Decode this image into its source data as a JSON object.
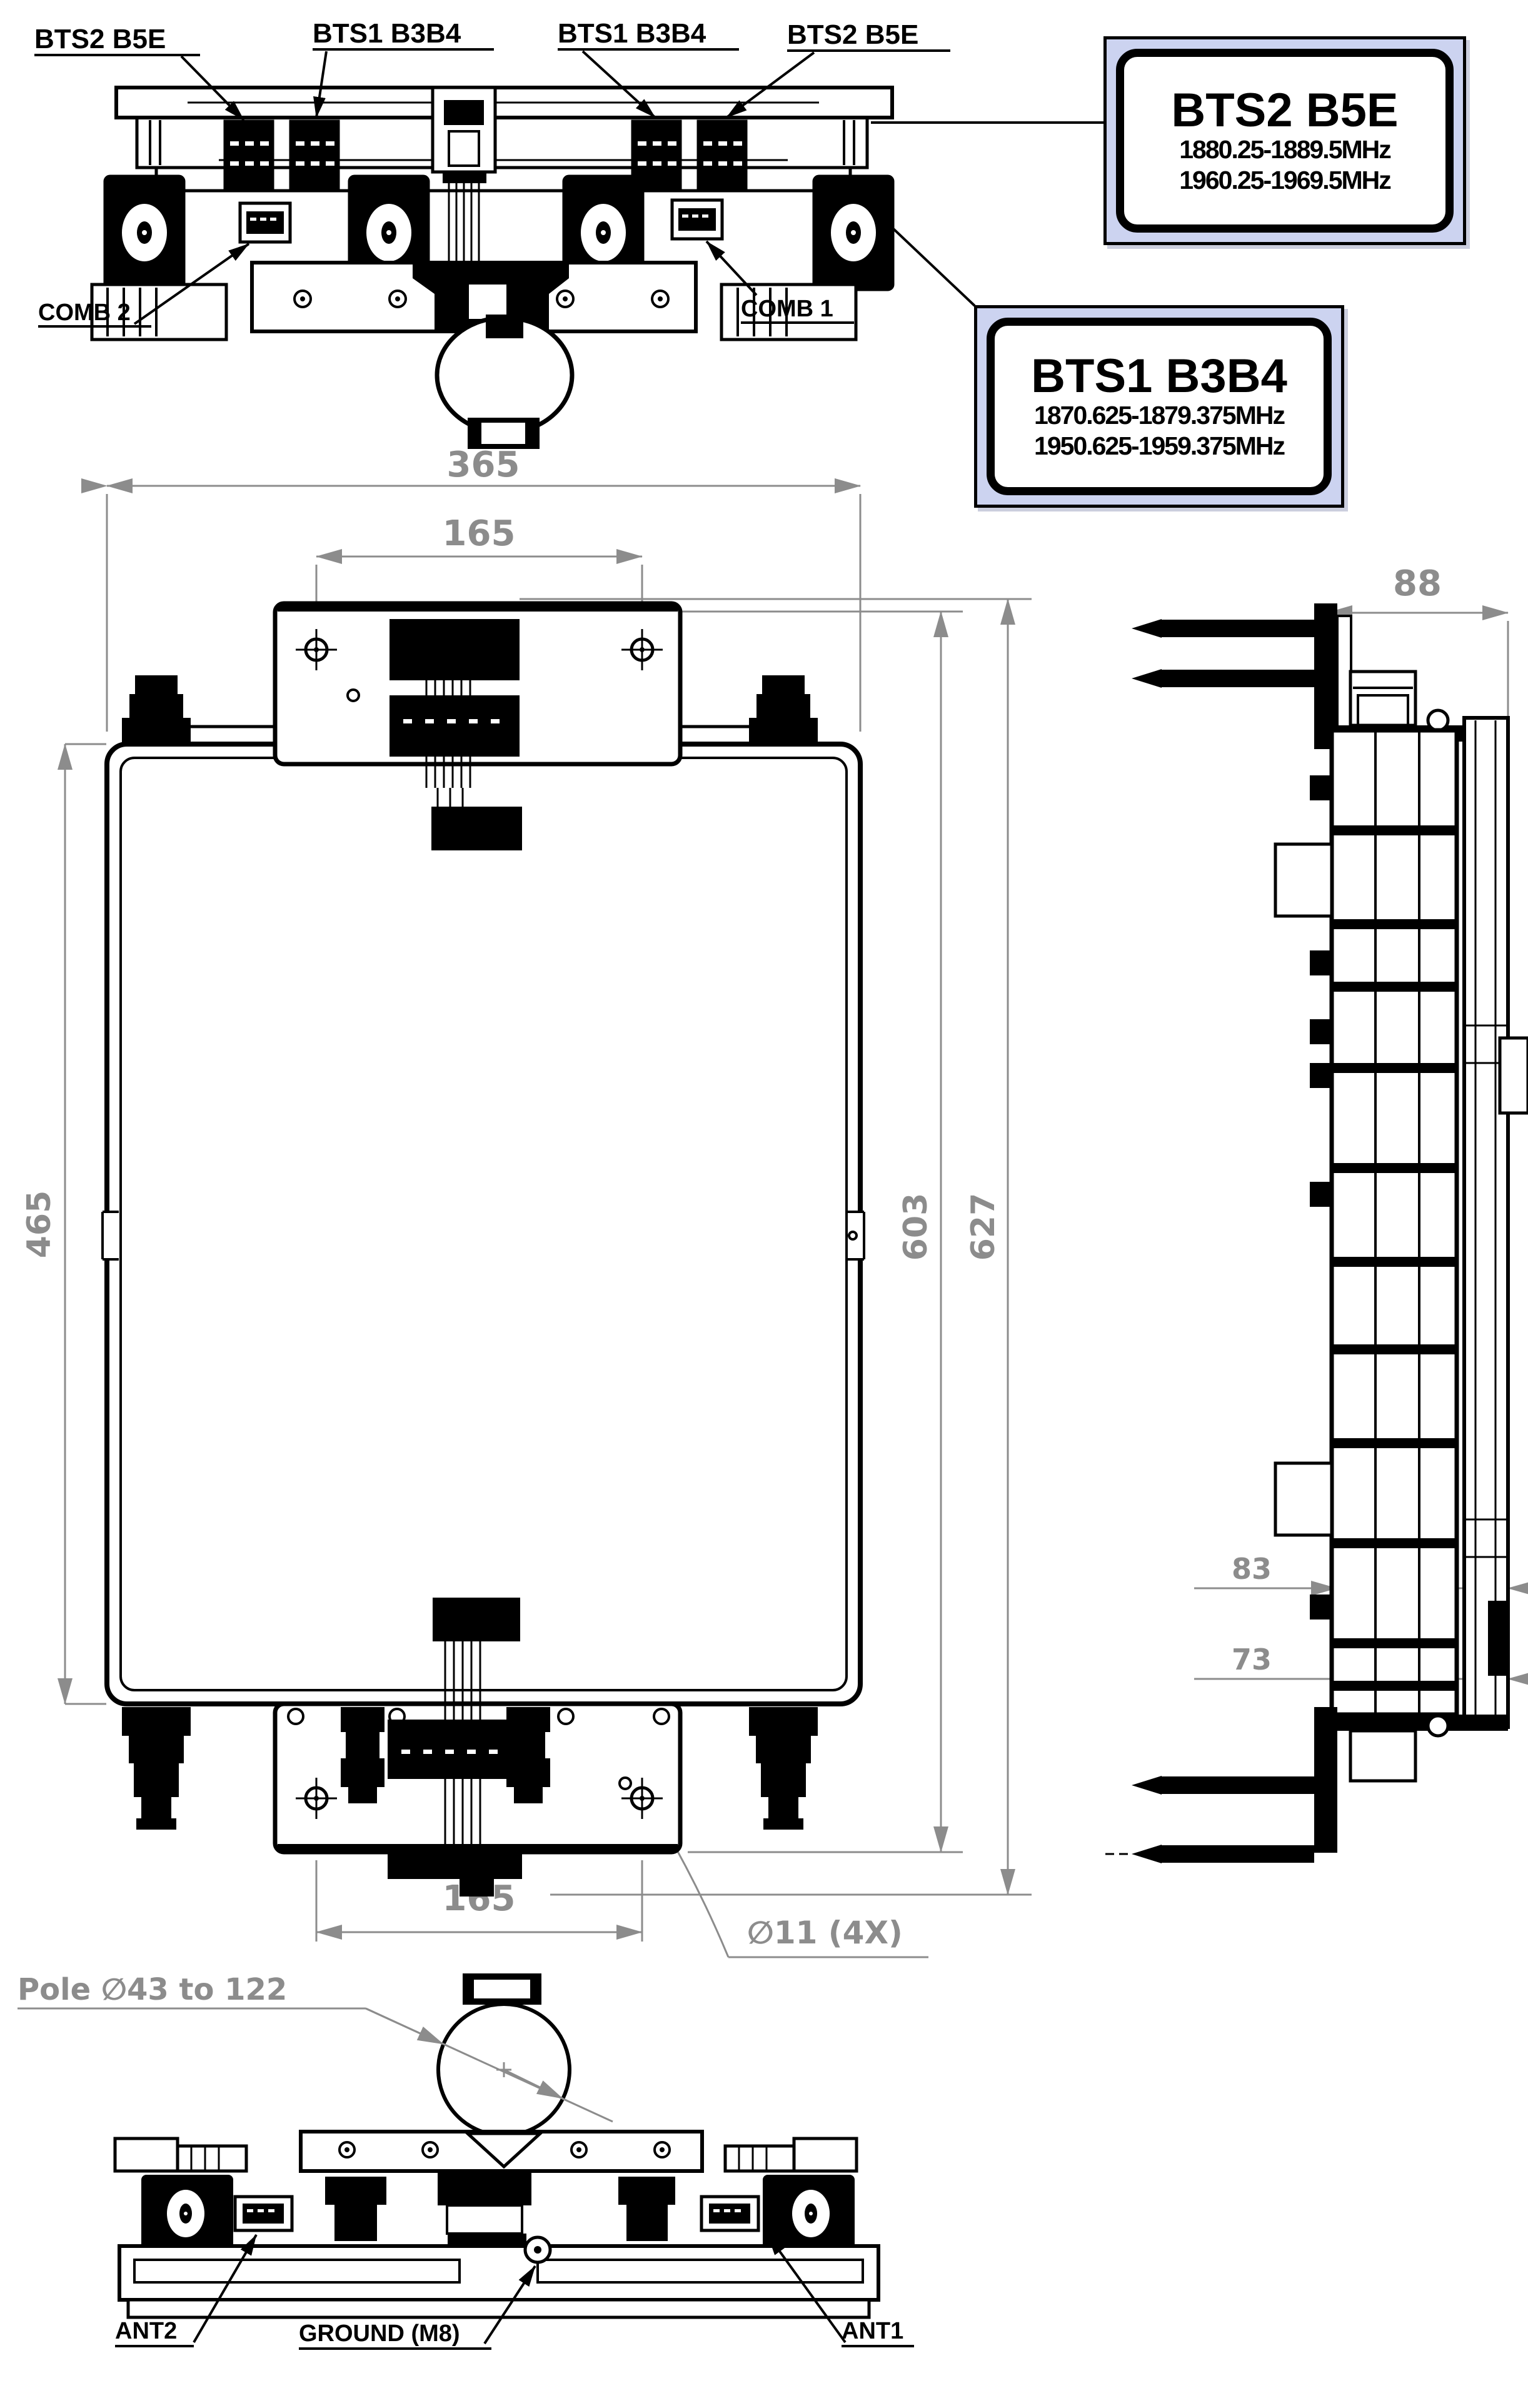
{
  "colors": {
    "line": "#000000",
    "dimension": "#8c8c8c",
    "label_box_bg": "#ccd3f0"
  },
  "top_view": {
    "callouts": {
      "bts2_left": "BTS2 B5E",
      "bts1_left": "BTS1 B3B4",
      "bts1_right": "BTS1 B3B4",
      "bts2_right": "BTS2 B5E",
      "comb2": "COMB 2",
      "comb1": "COMB 1"
    }
  },
  "label_boxes": {
    "bts2": {
      "title": "BTS2 B5E",
      "freq1": "1880.25-1889.5MHz",
      "freq2": "1960.25-1969.5MHz"
    },
    "bts1": {
      "title": "BTS1 B3B4",
      "freq1": "1870.625-1879.375MHz",
      "freq2": "1950.625-1959.375MHz"
    }
  },
  "front_view": {
    "dims": {
      "overall_width": "365",
      "top_hole_spacing": "165",
      "body_height": "465",
      "bracket_span": "603",
      "overall_height": "627",
      "bottom_hole_spacing": "165",
      "mount_hole_callout": "∅11 (4X)"
    }
  },
  "side_view": {
    "dims": {
      "depth": "88",
      "upper_offset": "83",
      "lower_offset": "73"
    }
  },
  "bottom_view": {
    "callouts": {
      "pole_range": "Pole ∅43 to 122",
      "ant2": "ANT2",
      "ground": "GROUND (M8)",
      "ant1": "ANT1"
    }
  }
}
